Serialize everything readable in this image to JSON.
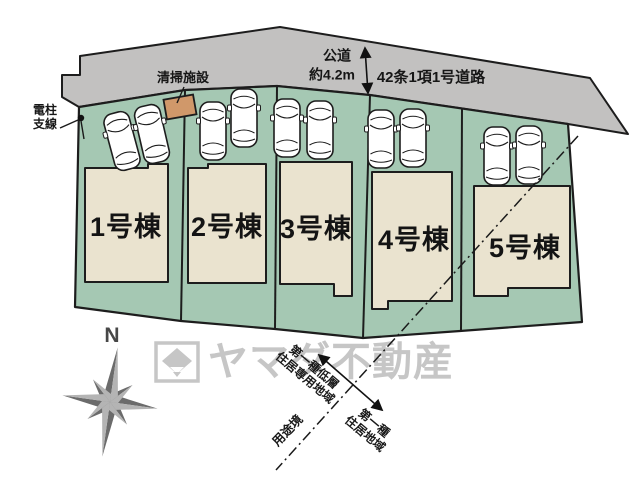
{
  "plan": {
    "road": {
      "surface_label": "公道",
      "width_label": "約4.2m",
      "name": "42条1項1号道路",
      "color": "#c2c1c0"
    },
    "facility": {
      "label": "清掃施設",
      "color": "#d0986a"
    },
    "utility_pole": {
      "label_line1": "電柱",
      "label_line2": "支線"
    },
    "lots": {
      "ground_color": "#a5c8b3",
      "building_color": "#eae3cf",
      "items": [
        {
          "label": "1号棟"
        },
        {
          "label": "2号棟"
        },
        {
          "label": "3号棟"
        },
        {
          "label": "4号棟"
        },
        {
          "label": "5号棟"
        }
      ]
    },
    "zoning": {
      "boundary_label": "用途境",
      "zone_a_line1": "第一種低層",
      "zone_a_line2": "住居専用地域",
      "zone_b_line1": "第一種",
      "zone_b_line2": "住居地域"
    },
    "compass": {
      "north_label": "N"
    },
    "watermark": {
      "text": "ヤマダ不動産",
      "color": "#c6c6c6"
    }
  }
}
